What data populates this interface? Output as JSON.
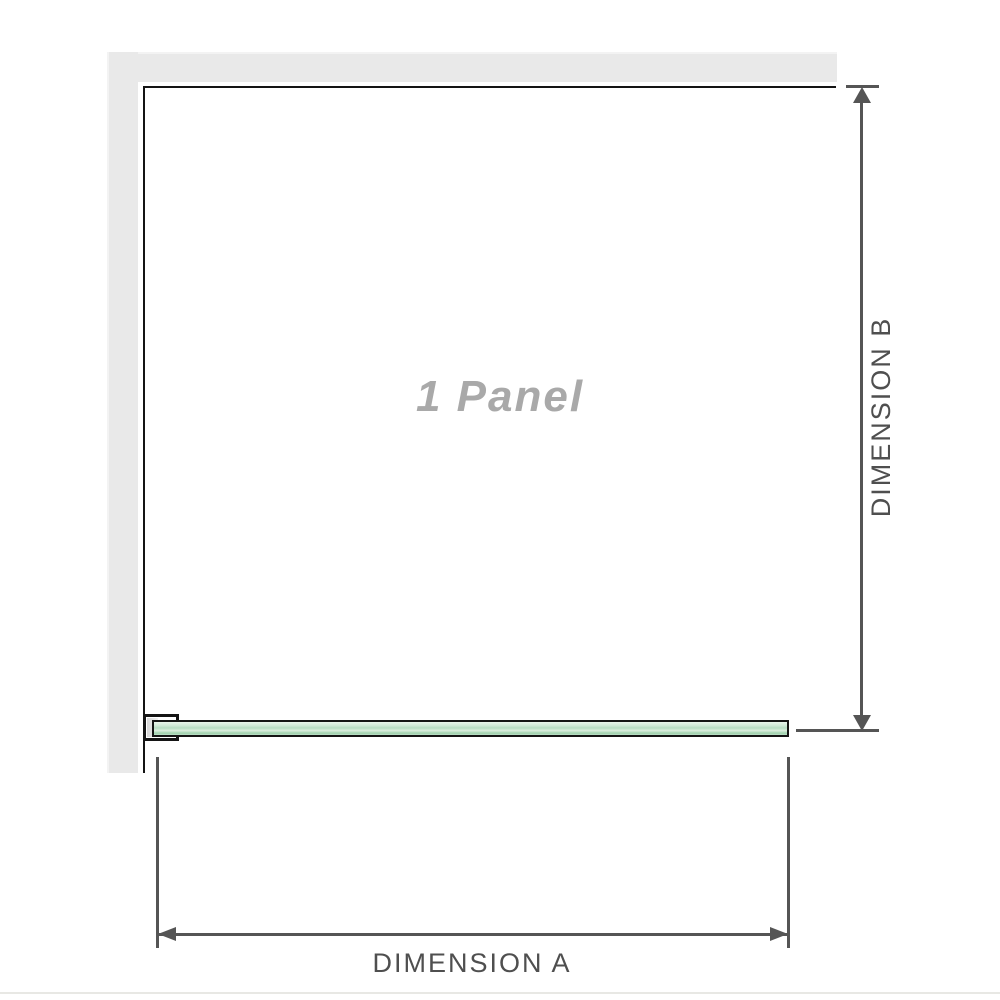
{
  "diagram": {
    "panel_label": "1 Panel",
    "dimension_a_label": "DIMENSION A",
    "dimension_b_label": "DIMENSION B"
  },
  "colors": {
    "wall": "#e9e9e9",
    "outline": "#141414",
    "dim": "#555555",
    "dim_text": "#4f4f4f",
    "label_gray": "#a9a9a9",
    "glass_light": "#dceede",
    "glass_mid": "#9fd2ad"
  }
}
